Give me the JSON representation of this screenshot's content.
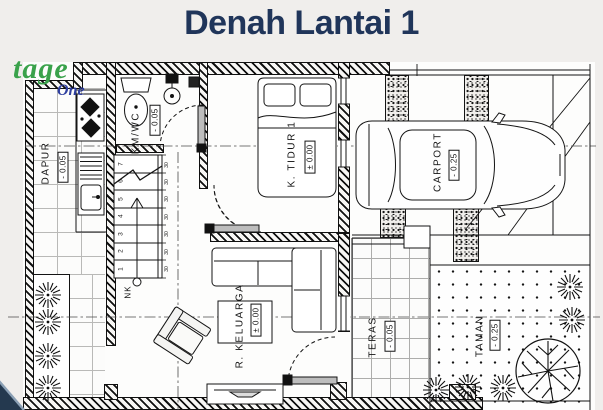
{
  "title": "Denah Lantai 1",
  "watermark": {
    "script": "tage",
    "suffix": "One"
  },
  "rooms": {
    "dapur": {
      "name": "DAPUR",
      "elev": "- 0.05"
    },
    "kmwc": {
      "name": "KM/WC",
      "elev": "- 0.05"
    },
    "ktidur1": {
      "name": "K. TIDUR 1",
      "elev": "± 0.00"
    },
    "carport": {
      "name": "CARPORT",
      "elev": "- 0.25"
    },
    "rkeluarga": {
      "name": "R. KELUARGA",
      "elev": "± 0.00"
    },
    "teras": {
      "name": "TERAS",
      "elev": "- 0.05"
    },
    "taman": {
      "name": "TAMAN",
      "elev": "- 0.25"
    }
  },
  "stairs": {
    "numbers": [
      "1",
      "2",
      "3",
      "4",
      "5",
      "6",
      "7"
    ],
    "tread_depth": "30",
    "direction_label": "NK"
  },
  "colors": {
    "title_navy": "#20355a",
    "watermark_green": "#3aa24b",
    "watermark_blue": "#2f3f9f",
    "line": "#141414",
    "corner_navy": "#24394f"
  }
}
